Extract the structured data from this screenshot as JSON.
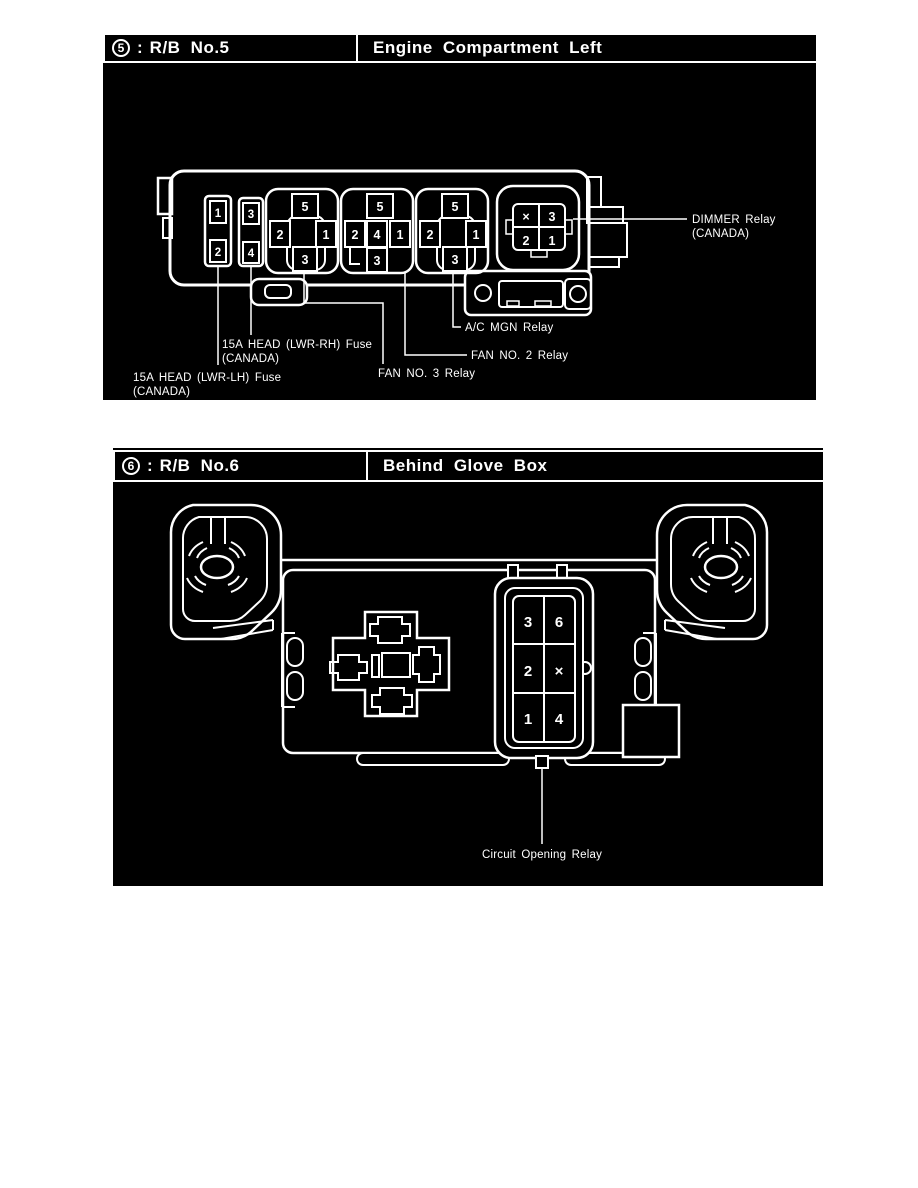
{
  "colors": {
    "panel_bg": "#000000",
    "line": "#ffffff",
    "page_bg": "#ffffff"
  },
  "rb5": {
    "badge": "5",
    "colon": ":",
    "box_id": "R/B No.5",
    "location": "Engine Compartment Left",
    "fuse_a": {
      "top": "1",
      "bottom": "2"
    },
    "fuse_b": {
      "top": "3",
      "bottom": "4"
    },
    "socket1": {
      "top": "5",
      "left": "2",
      "right": "1",
      "bottom": "3"
    },
    "socket2": {
      "top": "5",
      "left": "2",
      "center": "4",
      "right": "1",
      "bottom": "3"
    },
    "socket3": {
      "top": "5",
      "left": "2",
      "right": "1",
      "bottom": "3"
    },
    "dimmer_socket": {
      "tl": "×",
      "tr": "3",
      "bl": "2",
      "br": "1"
    },
    "labels": {
      "dimmer_1": "DIMMER Relay",
      "dimmer_2": "(CANADA)",
      "ac_mgn": "A/C MGN Relay",
      "fan_2": "FAN NO. 2 Relay",
      "fan_3": "FAN NO. 3 Relay",
      "head_rh_1": "15A HEAD (LWR-RH) Fuse",
      "head_rh_2": "(CANADA)",
      "head_lh_1": "15A HEAD (LWR-LH) Fuse",
      "head_lh_2": "(CANADA)"
    }
  },
  "rb6": {
    "badge": "6",
    "colon": ":",
    "box_id": "R/B No.6",
    "location": "Behind Glove Box",
    "relay_grid": {
      "r1c1": "3",
      "r1c2": "6",
      "r2c1": "2",
      "r2c2": "×",
      "r3c1": "1",
      "r3c2": "4"
    },
    "label": "Circuit Opening Relay"
  }
}
